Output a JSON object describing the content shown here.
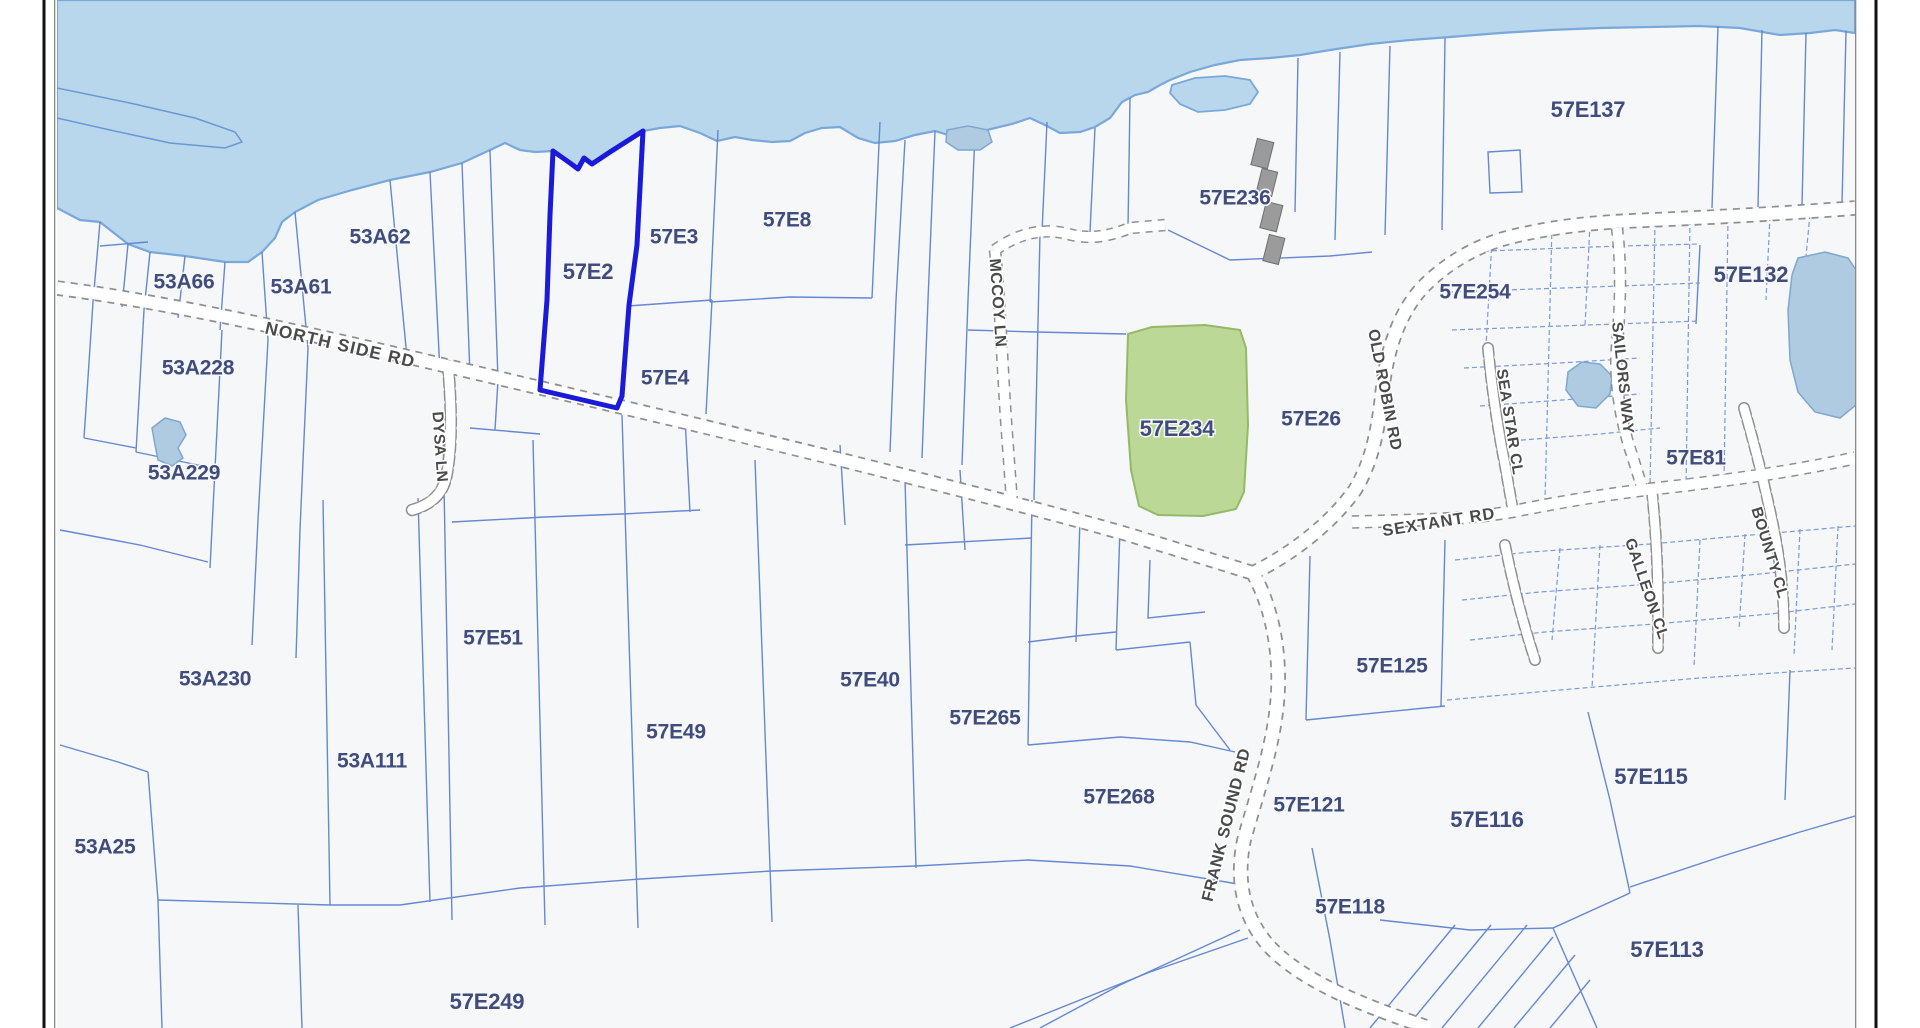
{
  "map": {
    "type": "cadastral-parcel-map",
    "highlighted_parcel": "57E2",
    "green_parcel": "57E234",
    "parcel_labels": [
      {
        "t": "53A66",
        "x": 184,
        "y": 283,
        "fs": 21
      },
      {
        "t": "53A61",
        "x": 301,
        "y": 288,
        "fs": 21
      },
      {
        "t": "53A62",
        "x": 380,
        "y": 238,
        "fs": 21
      },
      {
        "t": "53A228",
        "x": 198,
        "y": 369,
        "fs": 21
      },
      {
        "t": "53A229",
        "x": 184,
        "y": 474,
        "fs": 21
      },
      {
        "t": "57E2",
        "x": 588,
        "y": 273,
        "fs": 22
      },
      {
        "t": "57E3",
        "x": 674,
        "y": 238,
        "fs": 21
      },
      {
        "t": "57E8",
        "x": 787,
        "y": 221,
        "fs": 21
      },
      {
        "t": "57E4",
        "x": 665,
        "y": 379,
        "fs": 21
      },
      {
        "t": "57E236",
        "x": 1235,
        "y": 199,
        "fs": 21
      },
      {
        "t": "57E234",
        "x": 1177,
        "y": 430,
        "fs": 22
      },
      {
        "t": "57E26",
        "x": 1311,
        "y": 420,
        "fs": 21
      },
      {
        "t": "57E254",
        "x": 1475,
        "y": 293,
        "fs": 21
      },
      {
        "t": "57E137",
        "x": 1588,
        "y": 111,
        "fs": 22
      },
      {
        "t": "57E132",
        "x": 1751,
        "y": 276,
        "fs": 22
      },
      {
        "t": "57E81",
        "x": 1696,
        "y": 459,
        "fs": 21
      },
      {
        "t": "57E51",
        "x": 493,
        "y": 639,
        "fs": 21
      },
      {
        "t": "53A230",
        "x": 215,
        "y": 680,
        "fs": 21
      },
      {
        "t": "53A111",
        "x": 372,
        "y": 762,
        "fs": 21
      },
      {
        "t": "53A25",
        "x": 105,
        "y": 848,
        "fs": 21
      },
      {
        "t": "57E40",
        "x": 870,
        "y": 681,
        "fs": 21
      },
      {
        "t": "57E265",
        "x": 985,
        "y": 719,
        "fs": 21
      },
      {
        "t": "57E49",
        "x": 676,
        "y": 733,
        "fs": 21
      },
      {
        "t": "57E125",
        "x": 1392,
        "y": 667,
        "fs": 21
      },
      {
        "t": "57E268",
        "x": 1119,
        "y": 798,
        "fs": 21
      },
      {
        "t": "57E121",
        "x": 1309,
        "y": 806,
        "fs": 21
      },
      {
        "t": "57E116",
        "x": 1487,
        "y": 821,
        "fs": 22
      },
      {
        "t": "57E115",
        "x": 1651,
        "y": 778,
        "fs": 22
      },
      {
        "t": "57E118",
        "x": 1350,
        "y": 908,
        "fs": 21
      },
      {
        "t": "57E113",
        "x": 1667,
        "y": 951,
        "fs": 22
      },
      {
        "t": "57E249",
        "x": 487,
        "y": 1003,
        "fs": 22
      }
    ],
    "road_labels": [
      {
        "t": "NORTH SIDE RD",
        "x": 340,
        "y": 346,
        "rot": 13,
        "fs": 17.5,
        "ls": 1.2
      },
      {
        "t": "DYSA LN",
        "x": 439,
        "y": 447,
        "rot": 86,
        "fs": 15.5,
        "ls": 0.5
      },
      {
        "t": "MCCOY LN",
        "x": 997,
        "y": 303,
        "rot": 86,
        "fs": 16,
        "ls": 0.5
      },
      {
        "t": "OLD ROBIN RD",
        "x": 1384,
        "y": 390,
        "rot": 79,
        "fs": 16,
        "ls": 0.5
      },
      {
        "t": "SEXTANT RD",
        "x": 1439,
        "y": 523,
        "rot": -9,
        "fs": 16.5,
        "ls": 1
      },
      {
        "t": "SEA STAR CL",
        "x": 1509,
        "y": 422,
        "rot": 81,
        "fs": 15.5,
        "ls": 0.5
      },
      {
        "t": "SAILORS WAY",
        "x": 1622,
        "y": 378,
        "rot": 84,
        "fs": 15.5,
        "ls": 0.5
      },
      {
        "t": "GALLEON CL",
        "x": 1646,
        "y": 589,
        "rot": 71,
        "fs": 15.5,
        "ls": 0.5
      },
      {
        "t": "BOUNTY CL",
        "x": 1769,
        "y": 553,
        "rot": 73,
        "fs": 15.5,
        "ls": 0.5
      },
      {
        "t": "FRANK SOUND RD",
        "x": 1227,
        "y": 825,
        "rot": -76,
        "fs": 16.5,
        "ls": 0.5
      }
    ],
    "colors": {
      "water": "#b9d7ec",
      "coast": "#79a8da",
      "water_line": "#6b98d2",
      "land": "#f5f7f9",
      "pond": "#aecbe2",
      "pond_stroke": "#7fa7cf",
      "parcel_line": "#5f82cf",
      "parcel_line_light": "#7b99dd",
      "road_casing": "#8f8f8f",
      "road_fill": "#ffffff",
      "label": "#3f4c7c",
      "road_label": "#4a4a4a",
      "highlight": "#1b1ad8",
      "green_fill": "#bcd897",
      "green_stroke": "#94b96a",
      "building": "#9b9b9b",
      "building_stroke": "#6e6e6e",
      "frame": "#111111",
      "frame_inner": "#8a8a8a"
    }
  }
}
